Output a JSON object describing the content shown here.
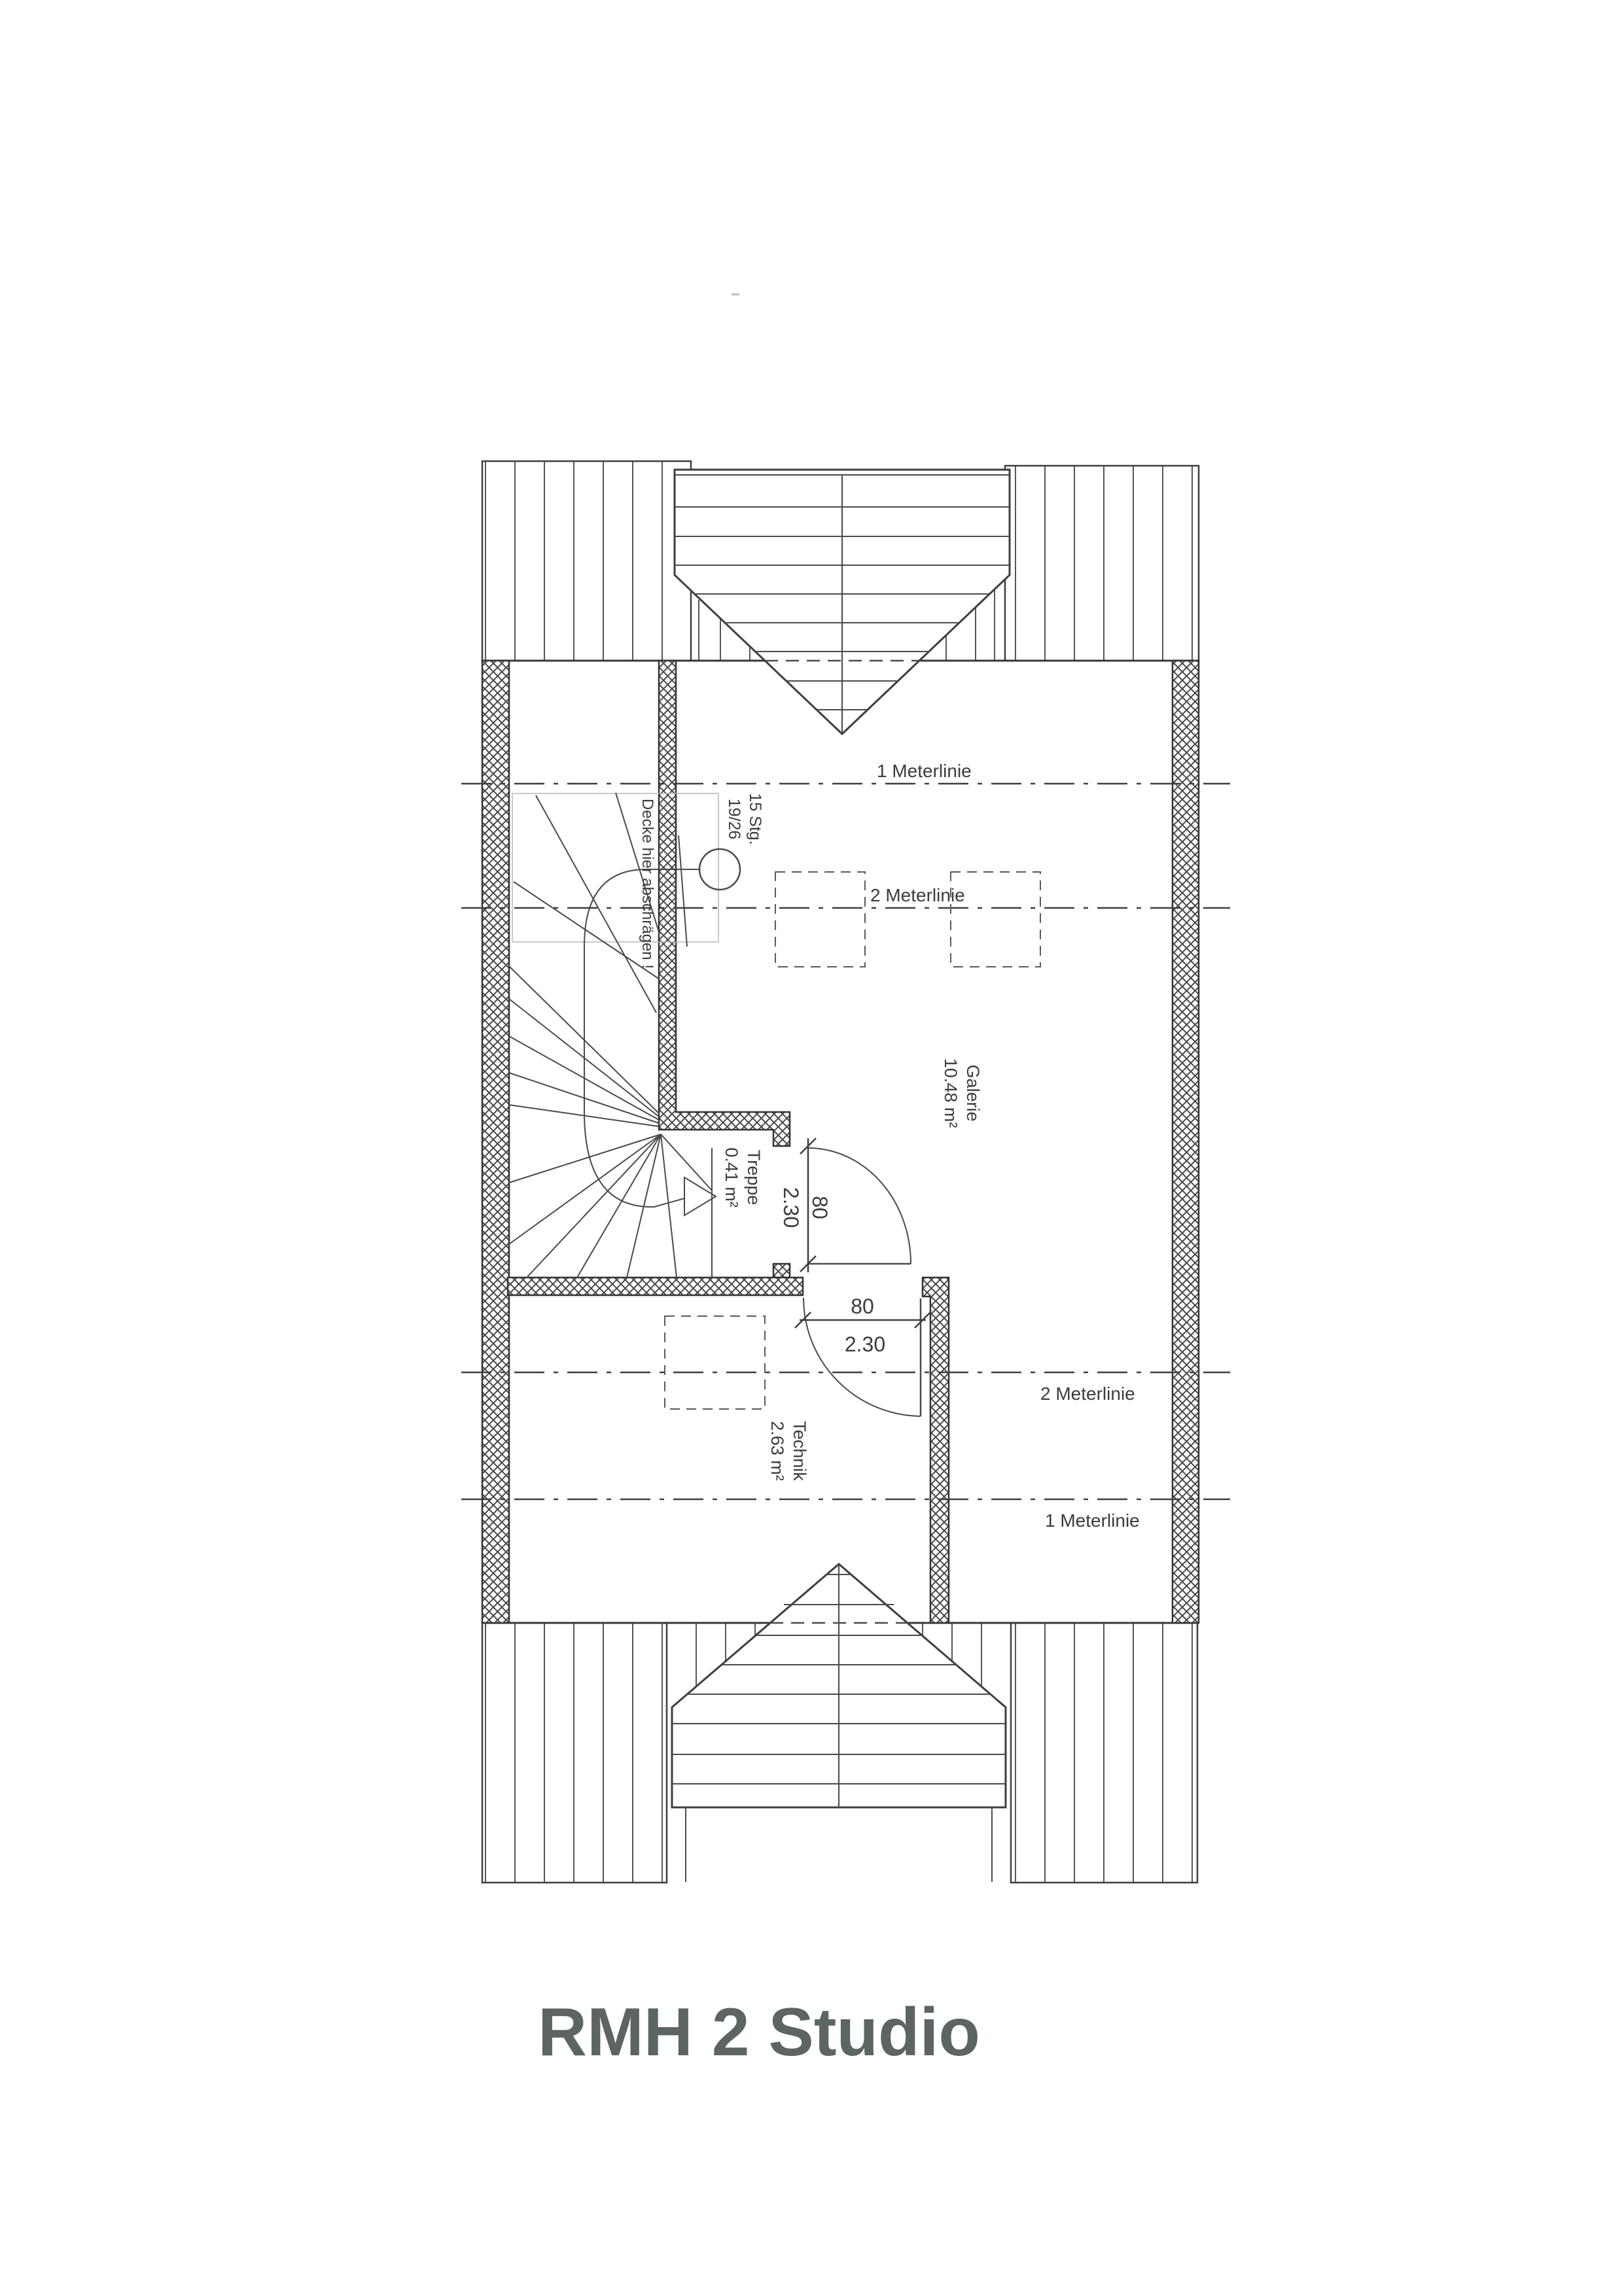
{
  "title": "RMH 2 Studio",
  "plan": {
    "meterlines": {
      "top_1": "1 Meterlinie",
      "top_2": "2 Meterlinie",
      "bottom_2": "2 Meterlinie",
      "bottom_1": "1 Meterlinie"
    },
    "rooms": {
      "galerie": {
        "name": "Galerie",
        "area": "10.48 m²"
      },
      "treppe": {
        "name": "Treppe",
        "area": "0.41 m²"
      },
      "technik": {
        "name": "Technik",
        "area": "2.63 m²"
      }
    },
    "stair": {
      "steps": "15 Stg.",
      "rise_run": "19/26",
      "note": "Decke hier abschrägen !"
    },
    "doors": {
      "door_upper": {
        "width": "80",
        "height": "2.30"
      },
      "door_lower": {
        "width": "80",
        "height": "2.30"
      }
    }
  }
}
